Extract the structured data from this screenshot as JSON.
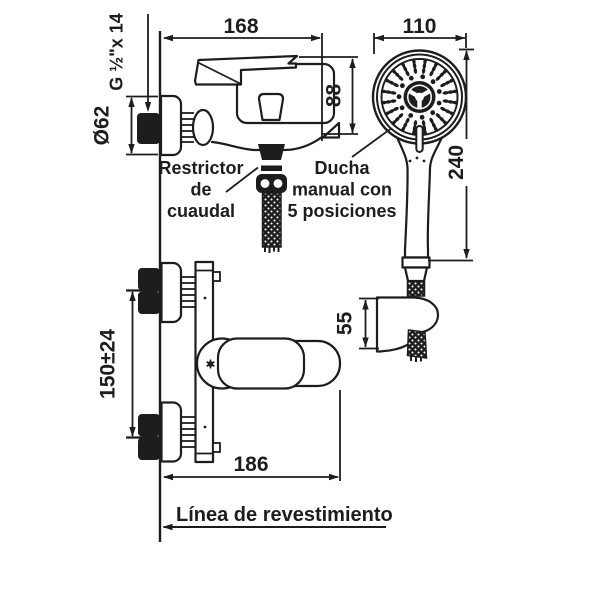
{
  "drawing": {
    "colors": {
      "line": "#1d1d1d",
      "background": "#ffffff"
    },
    "dimensions": {
      "faucet_width": "168",
      "shower_head_width": "110",
      "body_height": "88",
      "hand_shower_length": "240",
      "flange_diameter": "Ø62",
      "thread_spec": "G ½\"x 14",
      "inlet_spacing": "150±24",
      "projection": "186",
      "bracket_height": "55"
    },
    "callouts": {
      "flow_restrictor": [
        "Restrictor",
        "de",
        "cuaudal"
      ],
      "hand_shower": [
        "Ducha",
        "manual con",
        "5 posiciones"
      ],
      "wall_line": "Línea de revestimiento"
    }
  }
}
